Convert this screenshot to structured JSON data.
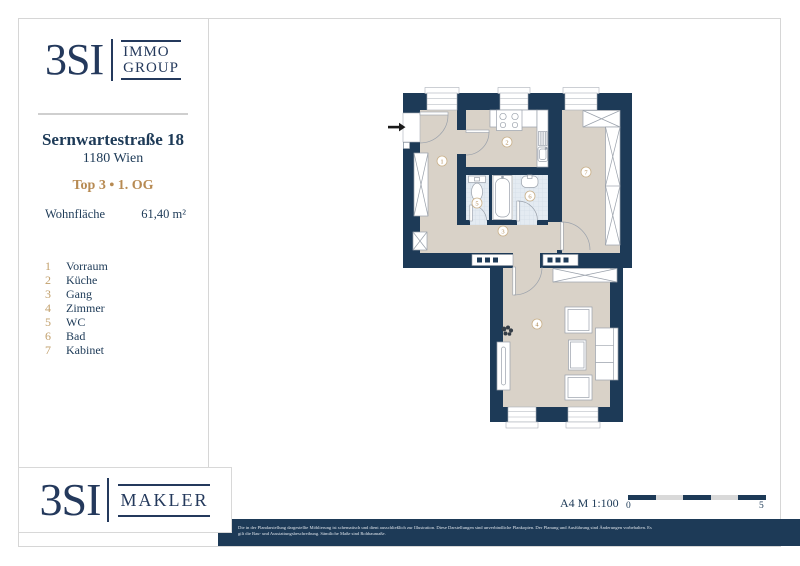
{
  "colors": {
    "navy": "#1d3a57",
    "gold": "#b78a52",
    "beige": "#d9d2c8",
    "tile": "#e4ebf2",
    "border_gray": "#d6d6d6"
  },
  "logo_top": {
    "brand": "3SI",
    "line1": "IMMO",
    "line2": "GROUP"
  },
  "property": {
    "street": "Sernwartestraße 18",
    "city": "1180 Wien",
    "unit": "Top 3 • 1. OG",
    "area_label": "Wohnfläche",
    "area_value": "61,40 m²"
  },
  "legend": {
    "items": [
      {
        "number": "1",
        "label": "Vorraum"
      },
      {
        "number": "2",
        "label": "Küche"
      },
      {
        "number": "3",
        "label": "Gang"
      },
      {
        "number": "4",
        "label": "Zimmer"
      },
      {
        "number": "5",
        "label": "WC"
      },
      {
        "number": "6",
        "label": "Bad"
      },
      {
        "number": "7",
        "label": "Kabinet"
      }
    ]
  },
  "footer": {
    "logo_brand": "3SI",
    "logo_division": "MAKLER",
    "sheet_scale": "A4  M 1:100",
    "scale_start": "0",
    "scale_end": "5",
    "disclaimer_line1": "Die in der Plandarstellung dargestellte Möblierung ist schematisch und dient ausschließlich zur Illustration. Diese Darstellungen sind unverbindliche Plankopien. Der Planung und Ausführung sind Änderungen vorbehalten. Es",
    "disclaimer_line2": "gilt die Bau- und Ausstattungsbeschreibung. Sämtliche Maße sind Rohbaumaße."
  },
  "icons": {
    "entrance_arrow": "black-right-arrow",
    "plant": "dark-plant-cluster"
  }
}
